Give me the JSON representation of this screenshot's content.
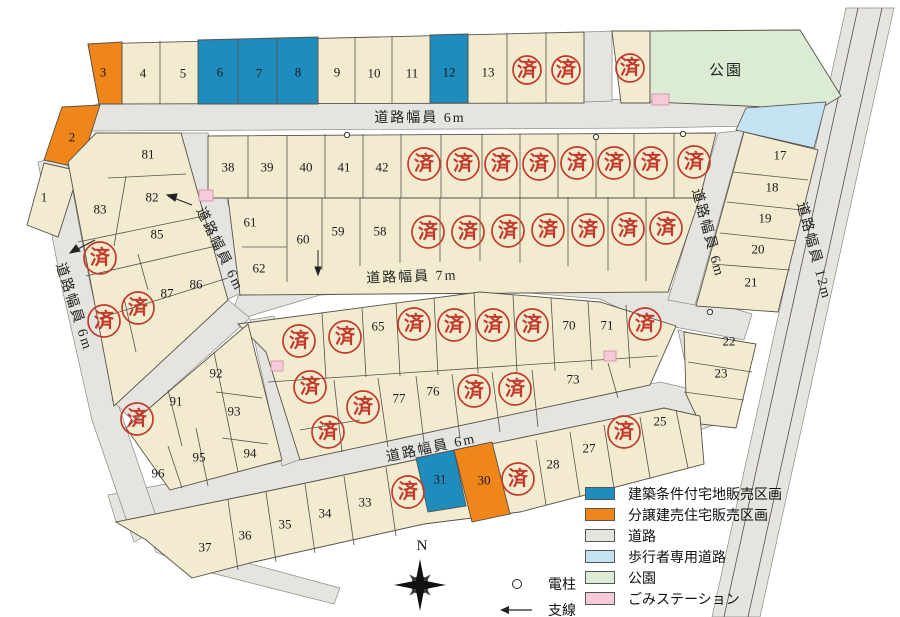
{
  "colors": {
    "cream": "#F3EBD0",
    "road": "#E6E4DF",
    "blue": "#1F8CBE",
    "orange": "#F08519",
    "yellow_green": "#E3EB55",
    "red": "#C23A2B",
    "park": "#DCEBD3",
    "ped": "#C5E2F2",
    "pink": "#F8C8DB",
    "line": "#55524A"
  },
  "park_label": "公園",
  "compass_label": "N",
  "roads": [
    {
      "id": "top-6m",
      "label": "道路幅員 6m",
      "x": 420,
      "y": 122,
      "rot": 0
    },
    {
      "id": "mid-7m",
      "label": "道路幅員 7m",
      "x": 412,
      "y": 281,
      "rot": -2
    },
    {
      "id": "lower-6m",
      "label": "道路幅員 6m",
      "x": 432,
      "y": 452,
      "rot": -12
    },
    {
      "id": "left-6m",
      "label": "道路幅員 6m",
      "x": 70,
      "y": 308,
      "rot": 72
    },
    {
      "id": "diag-6m",
      "label": "道路幅員 6m",
      "x": 216,
      "y": 251,
      "rot": 64
    },
    {
      "id": "right-6m",
      "label": "道路幅員 6m",
      "x": 704,
      "y": 234,
      "rot": 75
    },
    {
      "id": "right-12m",
      "label": "道路幅員 12m",
      "x": 810,
      "y": 252,
      "rot": 75
    }
  ],
  "lots": [
    {
      "n": "3",
      "x": 103,
      "y": 72
    },
    {
      "n": "4",
      "x": 143,
      "y": 73
    },
    {
      "n": "5",
      "x": 183,
      "y": 73
    },
    {
      "n": "6",
      "x": 220,
      "y": 72,
      "fs": 34,
      "fill": "#E3EB55"
    },
    {
      "n": "7",
      "x": 259,
      "y": 73,
      "fs": 34,
      "fill": "#E3EB55"
    },
    {
      "n": "8",
      "x": 298,
      "y": 72,
      "fs": 34,
      "fill": "#E3EB55"
    },
    {
      "n": "9",
      "x": 337,
      "y": 72
    },
    {
      "n": "10",
      "x": 374,
      "y": 73
    },
    {
      "n": "11",
      "x": 412,
      "y": 73
    },
    {
      "n": "12",
      "x": 449,
      "y": 72,
      "fs": 22,
      "fill": "#E3EB55"
    },
    {
      "n": "13",
      "x": 488,
      "y": 72
    },
    {
      "n": "2",
      "x": 72,
      "y": 137
    },
    {
      "n": "1",
      "x": 44,
      "y": 197
    },
    {
      "n": "38",
      "x": 228,
      "y": 167
    },
    {
      "n": "39",
      "x": 267,
      "y": 167
    },
    {
      "n": "40",
      "x": 306,
      "y": 167
    },
    {
      "n": "41",
      "x": 344,
      "y": 167
    },
    {
      "n": "42",
      "x": 382,
      "y": 167
    },
    {
      "n": "61",
      "x": 250,
      "y": 222
    },
    {
      "n": "62",
      "x": 259,
      "y": 268
    },
    {
      "n": "60",
      "x": 303,
      "y": 239
    },
    {
      "n": "59",
      "x": 338,
      "y": 231
    },
    {
      "n": "58",
      "x": 380,
      "y": 231
    },
    {
      "n": "17",
      "x": 780,
      "y": 155
    },
    {
      "n": "18",
      "x": 772,
      "y": 187
    },
    {
      "n": "19",
      "x": 765,
      "y": 218
    },
    {
      "n": "20",
      "x": 758,
      "y": 249
    },
    {
      "n": "21",
      "x": 751,
      "y": 282
    },
    {
      "n": "22",
      "x": 729,
      "y": 341
    },
    {
      "n": "23",
      "x": 721,
      "y": 373
    },
    {
      "n": "25",
      "x": 660,
      "y": 421
    },
    {
      "n": "27",
      "x": 589,
      "y": 448
    },
    {
      "n": "28",
      "x": 553,
      "y": 464
    },
    {
      "n": "30",
      "x": 484,
      "y": 480,
      "fs": 14
    },
    {
      "n": "31",
      "x": 440,
      "y": 479,
      "fs": 27,
      "fill": "#E3EB55"
    },
    {
      "n": "33",
      "x": 365,
      "y": 502
    },
    {
      "n": "34",
      "x": 325,
      "y": 513
    },
    {
      "n": "35",
      "x": 285,
      "y": 524
    },
    {
      "n": "36",
      "x": 245,
      "y": 535
    },
    {
      "n": "37",
      "x": 205,
      "y": 547
    },
    {
      "n": "81",
      "x": 148,
      "y": 154
    },
    {
      "n": "82",
      "x": 152,
      "y": 197
    },
    {
      "n": "83",
      "x": 100,
      "y": 209
    },
    {
      "n": "85",
      "x": 157,
      "y": 234
    },
    {
      "n": "86",
      "x": 196,
      "y": 284
    },
    {
      "n": "87",
      "x": 167,
      "y": 293
    },
    {
      "n": "65",
      "x": 378,
      "y": 326
    },
    {
      "n": "70",
      "x": 569,
      "y": 325
    },
    {
      "n": "71",
      "x": 607,
      "y": 325
    },
    {
      "n": "77",
      "x": 399,
      "y": 398
    },
    {
      "n": "76",
      "x": 433,
      "y": 391
    },
    {
      "n": "73",
      "x": 573,
      "y": 379
    },
    {
      "n": "91",
      "x": 176,
      "y": 401
    },
    {
      "n": "92",
      "x": 216,
      "y": 373
    },
    {
      "n": "93",
      "x": 234,
      "y": 411
    },
    {
      "n": "94",
      "x": 250,
      "y": 453
    },
    {
      "n": "95",
      "x": 199,
      "y": 457
    },
    {
      "n": "96",
      "x": 158,
      "y": 473
    }
  ],
  "sold_mark": "済",
  "sold": [
    [
      527,
      70,
      14
    ],
    [
      566,
      70,
      14
    ],
    [
      630,
      68,
      14
    ],
    [
      424,
      164
    ],
    [
      463,
      164
    ],
    [
      501,
      164
    ],
    [
      539,
      164
    ],
    [
      577,
      163
    ],
    [
      614,
      163
    ],
    [
      651,
      163
    ],
    [
      694,
      162
    ],
    [
      428,
      232
    ],
    [
      468,
      232
    ],
    [
      508,
      231
    ],
    [
      548,
      230
    ],
    [
      588,
      230
    ],
    [
      628,
      229
    ],
    [
      666,
      228
    ],
    [
      100,
      258
    ],
    [
      104,
      321
    ],
    [
      138,
      308
    ],
    [
      299,
      341
    ],
    [
      345,
      337
    ],
    [
      414,
      324
    ],
    [
      454,
      325
    ],
    [
      493,
      325
    ],
    [
      532,
      325
    ],
    [
      645,
      324
    ],
    [
      310,
      387
    ],
    [
      363,
      407
    ],
    [
      474,
      391
    ],
    [
      515,
      389
    ],
    [
      328,
      432
    ],
    [
      137,
      419
    ],
    [
      408,
      492
    ],
    [
      518,
      479
    ],
    [
      624,
      432
    ]
  ],
  "legend": {
    "items": [
      {
        "label": "建築条件付宅地販売区画",
        "color": "#1F8CBE"
      },
      {
        "label": "分譲建売住宅販売区画",
        "color": "#F08519"
      },
      {
        "label": "道路",
        "color": "#E6E4DF"
      },
      {
        "label": "歩行者専用道路",
        "color": "#C5E2F2"
      },
      {
        "label": "公園",
        "color": "#DCEBD3"
      },
      {
        "label": "ごみステーション",
        "color": "#F8C8DB"
      }
    ],
    "symbols": [
      {
        "label": "電柱",
        "type": "circle-icon"
      },
      {
        "label": "支線",
        "type": "arrow-icon"
      }
    ]
  }
}
